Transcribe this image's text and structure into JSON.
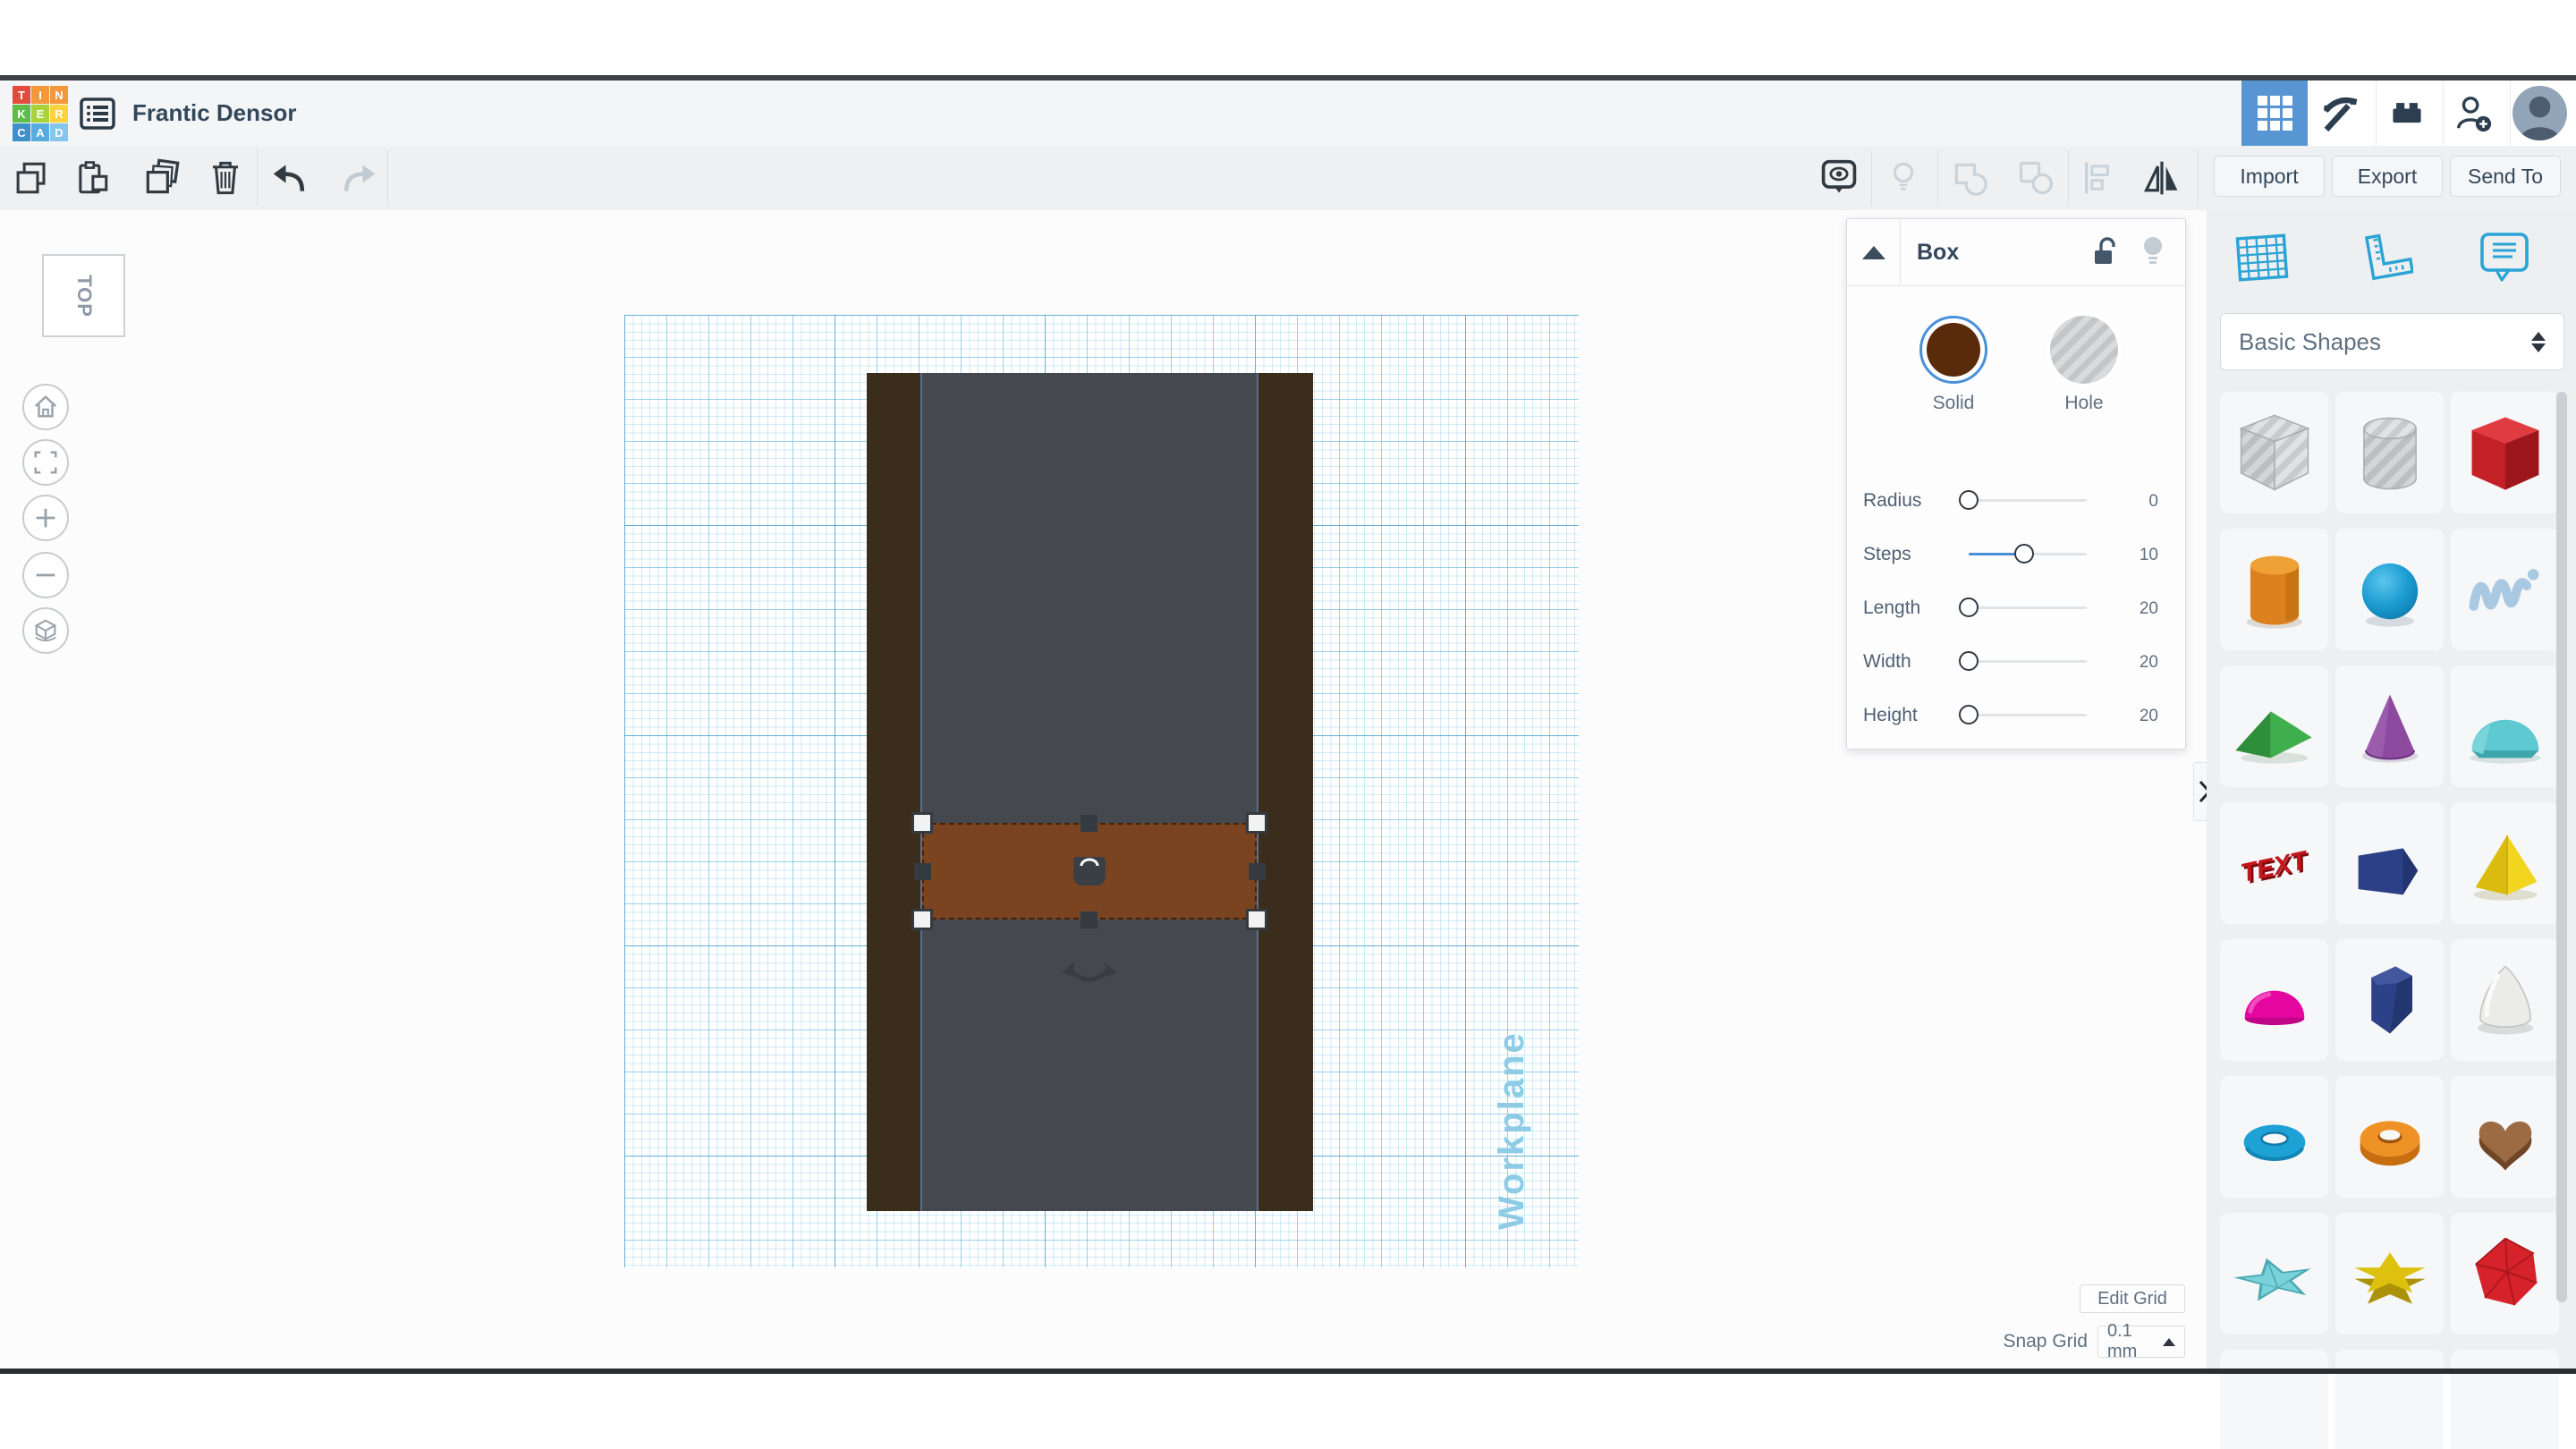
{
  "header": {
    "logo_letters": [
      "T",
      "I",
      "N",
      "K",
      "E",
      "R",
      "C",
      "A",
      "D"
    ],
    "title": "Frantic Densor"
  },
  "toolbar": {
    "import_label": "Import",
    "export_label": "Export",
    "send_to_label": "Send To"
  },
  "inspector": {
    "title": "Box",
    "solid_label": "Solid",
    "hole_label": "Hole",
    "sliders": [
      {
        "label": "Radius",
        "value": "0"
      },
      {
        "label": "Steps",
        "value": "10"
      },
      {
        "label": "Length",
        "value": "20"
      },
      {
        "label": "Width",
        "value": "20"
      },
      {
        "label": "Height",
        "value": "20"
      }
    ]
  },
  "sidebar": {
    "category": "Basic Shapes",
    "shapes": [
      "box-hole",
      "cylinder-hole",
      "box",
      "cylinder",
      "sphere",
      "scribble",
      "roof",
      "cone",
      "round-roof",
      "text",
      "wedge",
      "pyramid",
      "half-sphere",
      "polygon",
      "paraboloid",
      "torus",
      "tube",
      "heart",
      "star",
      "thick-star",
      "icosahedron"
    ]
  },
  "viewport": {
    "view_cube": "TOP",
    "workplane_label": "Workplane",
    "edit_grid_label": "Edit Grid",
    "snap_grid_label": "Snap Grid",
    "snap_grid_value": "0.1 mm"
  },
  "colors": {
    "accent_blue": "#4a90d9",
    "active_tab_blue": "#5796d3",
    "solid_swatch_brown": "#5a2b0a",
    "selected_box_brown": "#7a4421",
    "rail_brown": "#3b2d1c",
    "slab_gray": "#45484e",
    "workplane_blue": "#8ecbe5"
  }
}
